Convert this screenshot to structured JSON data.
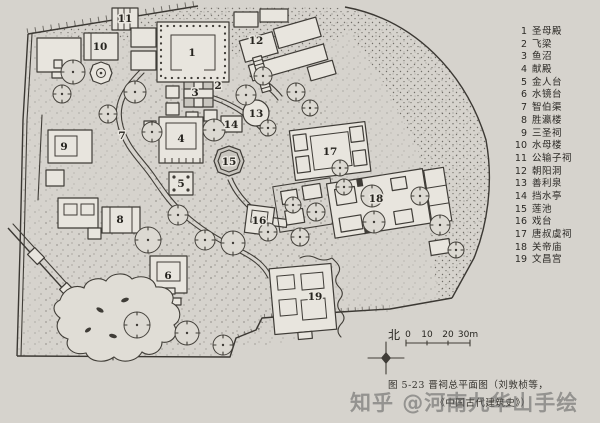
{
  "colors": {
    "paper": "#d6d3cd",
    "ink": "#3f3c37",
    "building_fill": "#e8e5de",
    "water_fill": "#c9c6bf",
    "watermark_gray": "#5f5f5f"
  },
  "legend": {
    "items": [
      {
        "num": "1",
        "label": "圣母殿"
      },
      {
        "num": "2",
        "label": "飞梁"
      },
      {
        "num": "3",
        "label": "鱼沼"
      },
      {
        "num": "4",
        "label": "献殿"
      },
      {
        "num": "5",
        "label": "金人台"
      },
      {
        "num": "6",
        "label": "水镜台"
      },
      {
        "num": "7",
        "label": "智伯渠"
      },
      {
        "num": "8",
        "label": "胜瀛楼"
      },
      {
        "num": "9",
        "label": "三圣祠"
      },
      {
        "num": "10",
        "label": "水母楼"
      },
      {
        "num": "11",
        "label": "公输子祠"
      },
      {
        "num": "12",
        "label": "朝阳洞"
      },
      {
        "num": "13",
        "label": "善利泉"
      },
      {
        "num": "14",
        "label": "挡水亭"
      },
      {
        "num": "15",
        "label": "莲池"
      },
      {
        "num": "16",
        "label": "戏台"
      },
      {
        "num": "17",
        "label": "唐叔虞祠"
      },
      {
        "num": "18",
        "label": "关帝庙"
      },
      {
        "num": "19",
        "label": "文昌宫"
      }
    ]
  },
  "map": {
    "labels": [
      {
        "n": "1",
        "x": 192,
        "y": 53
      },
      {
        "n": "2",
        "x": 218,
        "y": 86
      },
      {
        "n": "3",
        "x": 195,
        "y": 93
      },
      {
        "n": "4",
        "x": 181,
        "y": 139
      },
      {
        "n": "5",
        "x": 181,
        "y": 184
      },
      {
        "n": "6",
        "x": 168,
        "y": 276
      },
      {
        "n": "7",
        "x": 122,
        "y": 136
      },
      {
        "n": "8",
        "x": 120,
        "y": 220
      },
      {
        "n": "9",
        "x": 64,
        "y": 147
      },
      {
        "n": "10",
        "x": 100,
        "y": 47
      },
      {
        "n": "11",
        "x": 125,
        "y": 19
      },
      {
        "n": "12",
        "x": 256,
        "y": 41
      },
      {
        "n": "13",
        "x": 256,
        "y": 114
      },
      {
        "n": "14",
        "x": 231,
        "y": 125
      },
      {
        "n": "15",
        "x": 229,
        "y": 162
      },
      {
        "n": "16",
        "x": 259,
        "y": 221
      },
      {
        "n": "17",
        "x": 330,
        "y": 152
      },
      {
        "n": "18",
        "x": 376,
        "y": 199
      },
      {
        "n": "19",
        "x": 315,
        "y": 297
      }
    ],
    "compass": {
      "north_label": "北"
    },
    "scale": {
      "ticks": [
        "0",
        "10",
        "20",
        "30m"
      ]
    }
  },
  "caption": {
    "line1": "图 5-23  晋祠总平面图（刘敦桢等，",
    "line2": "《中国古代建筑史》）"
  },
  "watermark": {
    "text": "知乎 @河南九华山手绘"
  }
}
